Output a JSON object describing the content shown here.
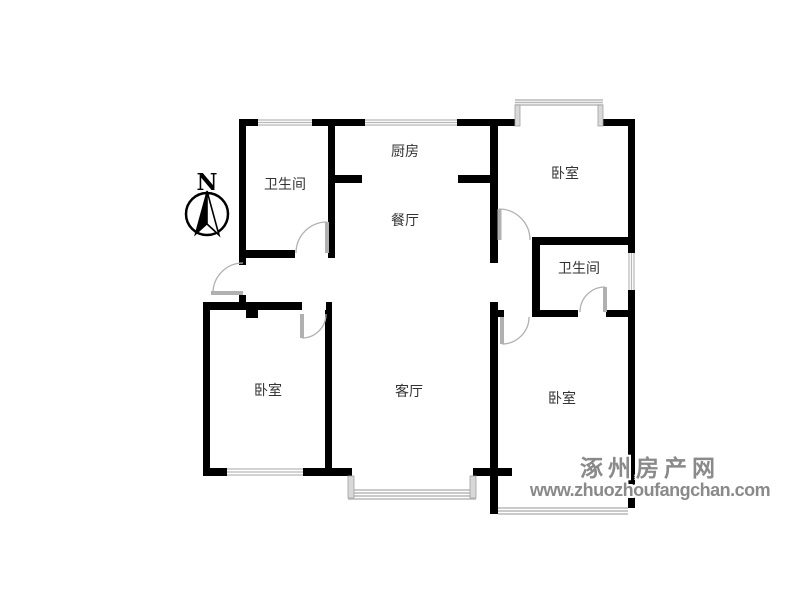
{
  "canvas": {
    "width": 800,
    "height": 600,
    "background": "#ffffff"
  },
  "colors": {
    "wall": "#000000",
    "window_line": "#b8b8b8",
    "bay_bar_fill": "#d8d8d8",
    "bay_bar_stroke": "#a0a0a0",
    "door": "#b0b0b0",
    "label": "#333333",
    "watermark": "#8a8a8a",
    "watermark_outline": "#ffffff"
  },
  "compass": {
    "label": "N",
    "cx": 207,
    "cy": 214,
    "r": 21
  },
  "rooms": [
    {
      "id": "bathroom-nw",
      "label": "卫生间",
      "cx": 285,
      "cy": 184
    },
    {
      "id": "kitchen",
      "label": "厨房",
      "cx": 405,
      "cy": 151
    },
    {
      "id": "dining",
      "label": "餐厅",
      "cx": 405,
      "cy": 220
    },
    {
      "id": "bedroom-ne",
      "label": "卧室",
      "cx": 565,
      "cy": 173
    },
    {
      "id": "bathroom-e",
      "label": "卫生间",
      "cx": 579,
      "cy": 268
    },
    {
      "id": "bedroom-sw",
      "label": "卧室",
      "cx": 268,
      "cy": 390
    },
    {
      "id": "living",
      "label": "客厅",
      "cx": 409,
      "cy": 391
    },
    {
      "id": "bedroom-se",
      "label": "卧室",
      "cx": 562,
      "cy": 398
    },
    {
      "id": "balcony",
      "label": "阳台",
      "cx": 560,
      "cy": 491
    }
  ],
  "plan": {
    "walls": [
      [
        239,
        119,
        19,
        7
      ],
      [
        312,
        119,
        53,
        7
      ],
      [
        457,
        119,
        60,
        7
      ],
      [
        603,
        119,
        32,
        7
      ],
      [
        239,
        126,
        7,
        139
      ],
      [
        239,
        295,
        7,
        15
      ],
      [
        203,
        302,
        7,
        174
      ],
      [
        203,
        302,
        99,
        8
      ],
      [
        326,
        302,
        6,
        8
      ],
      [
        325,
        310,
        7,
        166
      ],
      [
        246,
        302,
        12,
        16
      ],
      [
        239,
        250,
        56,
        8
      ],
      [
        328,
        126,
        7,
        132
      ],
      [
        335,
        175,
        27,
        8
      ],
      [
        458,
        175,
        32,
        8
      ],
      [
        490,
        126,
        8,
        137
      ],
      [
        490,
        302,
        8,
        174
      ],
      [
        490,
        476,
        8,
        38
      ],
      [
        628,
        126,
        7,
        127
      ],
      [
        628,
        290,
        7,
        218
      ],
      [
        532,
        237,
        96,
        8
      ],
      [
        532,
        245,
        8,
        72
      ],
      [
        532,
        310,
        46,
        7
      ],
      [
        606,
        310,
        22,
        7
      ],
      [
        498,
        310,
        6,
        7
      ],
      [
        203,
        468,
        24,
        8
      ],
      [
        303,
        468,
        49,
        8
      ],
      [
        473,
        468,
        25,
        8
      ],
      [
        490,
        468,
        22,
        8
      ]
    ],
    "windows": [
      {
        "rect": [
          258,
          119,
          54,
          7
        ],
        "dir": "h"
      },
      {
        "rect": [
          365,
          119,
          92,
          7
        ],
        "dir": "h"
      },
      {
        "rect": [
          227,
          468,
          76,
          8
        ],
        "dir": "h"
      },
      {
        "rect": [
          628,
          253,
          7,
          37
        ],
        "dir": "v"
      }
    ],
    "bays": [
      {
        "name": "bay-window-north",
        "bars": [
          [
            515,
            105,
            5,
            21
          ],
          [
            598,
            105,
            5,
            21
          ]
        ],
        "lines": [
          [
            515,
            100,
            603,
            100
          ],
          [
            515,
            102.5,
            603,
            102.5
          ],
          [
            515,
            105,
            603,
            105
          ]
        ]
      },
      {
        "name": "bay-window-south",
        "bars": [
          [
            348,
            476,
            6,
            22
          ],
          [
            470,
            476,
            6,
            22
          ]
        ],
        "lines": [
          [
            348,
            490,
            476,
            490
          ],
          [
            348,
            493,
            476,
            493
          ],
          [
            348,
            496,
            476,
            496
          ],
          [
            348,
            499,
            476,
            499
          ]
        ]
      },
      {
        "name": "balcony-window",
        "bars": [],
        "lines": [
          [
            498,
            508,
            628,
            508
          ],
          [
            498,
            511,
            628,
            511
          ],
          [
            498,
            514,
            628,
            514
          ]
        ]
      }
    ],
    "doors": [
      {
        "name": "bathroom-nw-door",
        "leaf": [
          327,
          222,
          327,
          253
        ],
        "arc": "M 296 253 A 31 31 0 0 1 327 222"
      },
      {
        "name": "entrance-door",
        "leaf": [
          211,
          293,
          243,
          293
        ],
        "arc": "M 243 263 A 30 30 0 0 0 213 293"
      },
      {
        "name": "bedroom-ne-door",
        "leaf": [
          499.5,
          209,
          499.5,
          240
        ],
        "arc": "M 499 209 A 31 31 0 0 1 530 240"
      },
      {
        "name": "bathroom-e-door",
        "leaf": [
          605,
          287,
          605,
          312
        ],
        "arc": "M 605 287 A 25 25 0 0 0 580 312"
      },
      {
        "name": "bedroom-se-door",
        "leaf": [
          502,
          317,
          502,
          344
        ],
        "arc": "M 529 317 A 27 27 0 0 1 502 344"
      },
      {
        "name": "bedroom-sw-door",
        "leaf": [
          302,
          314,
          302,
          338
        ],
        "arc": "M 326 314 A 24 24 0 0 1 302 338"
      }
    ]
  },
  "watermark": {
    "title": "涿州房产网",
    "url": "www.zhuozhoufangchan.com"
  }
}
